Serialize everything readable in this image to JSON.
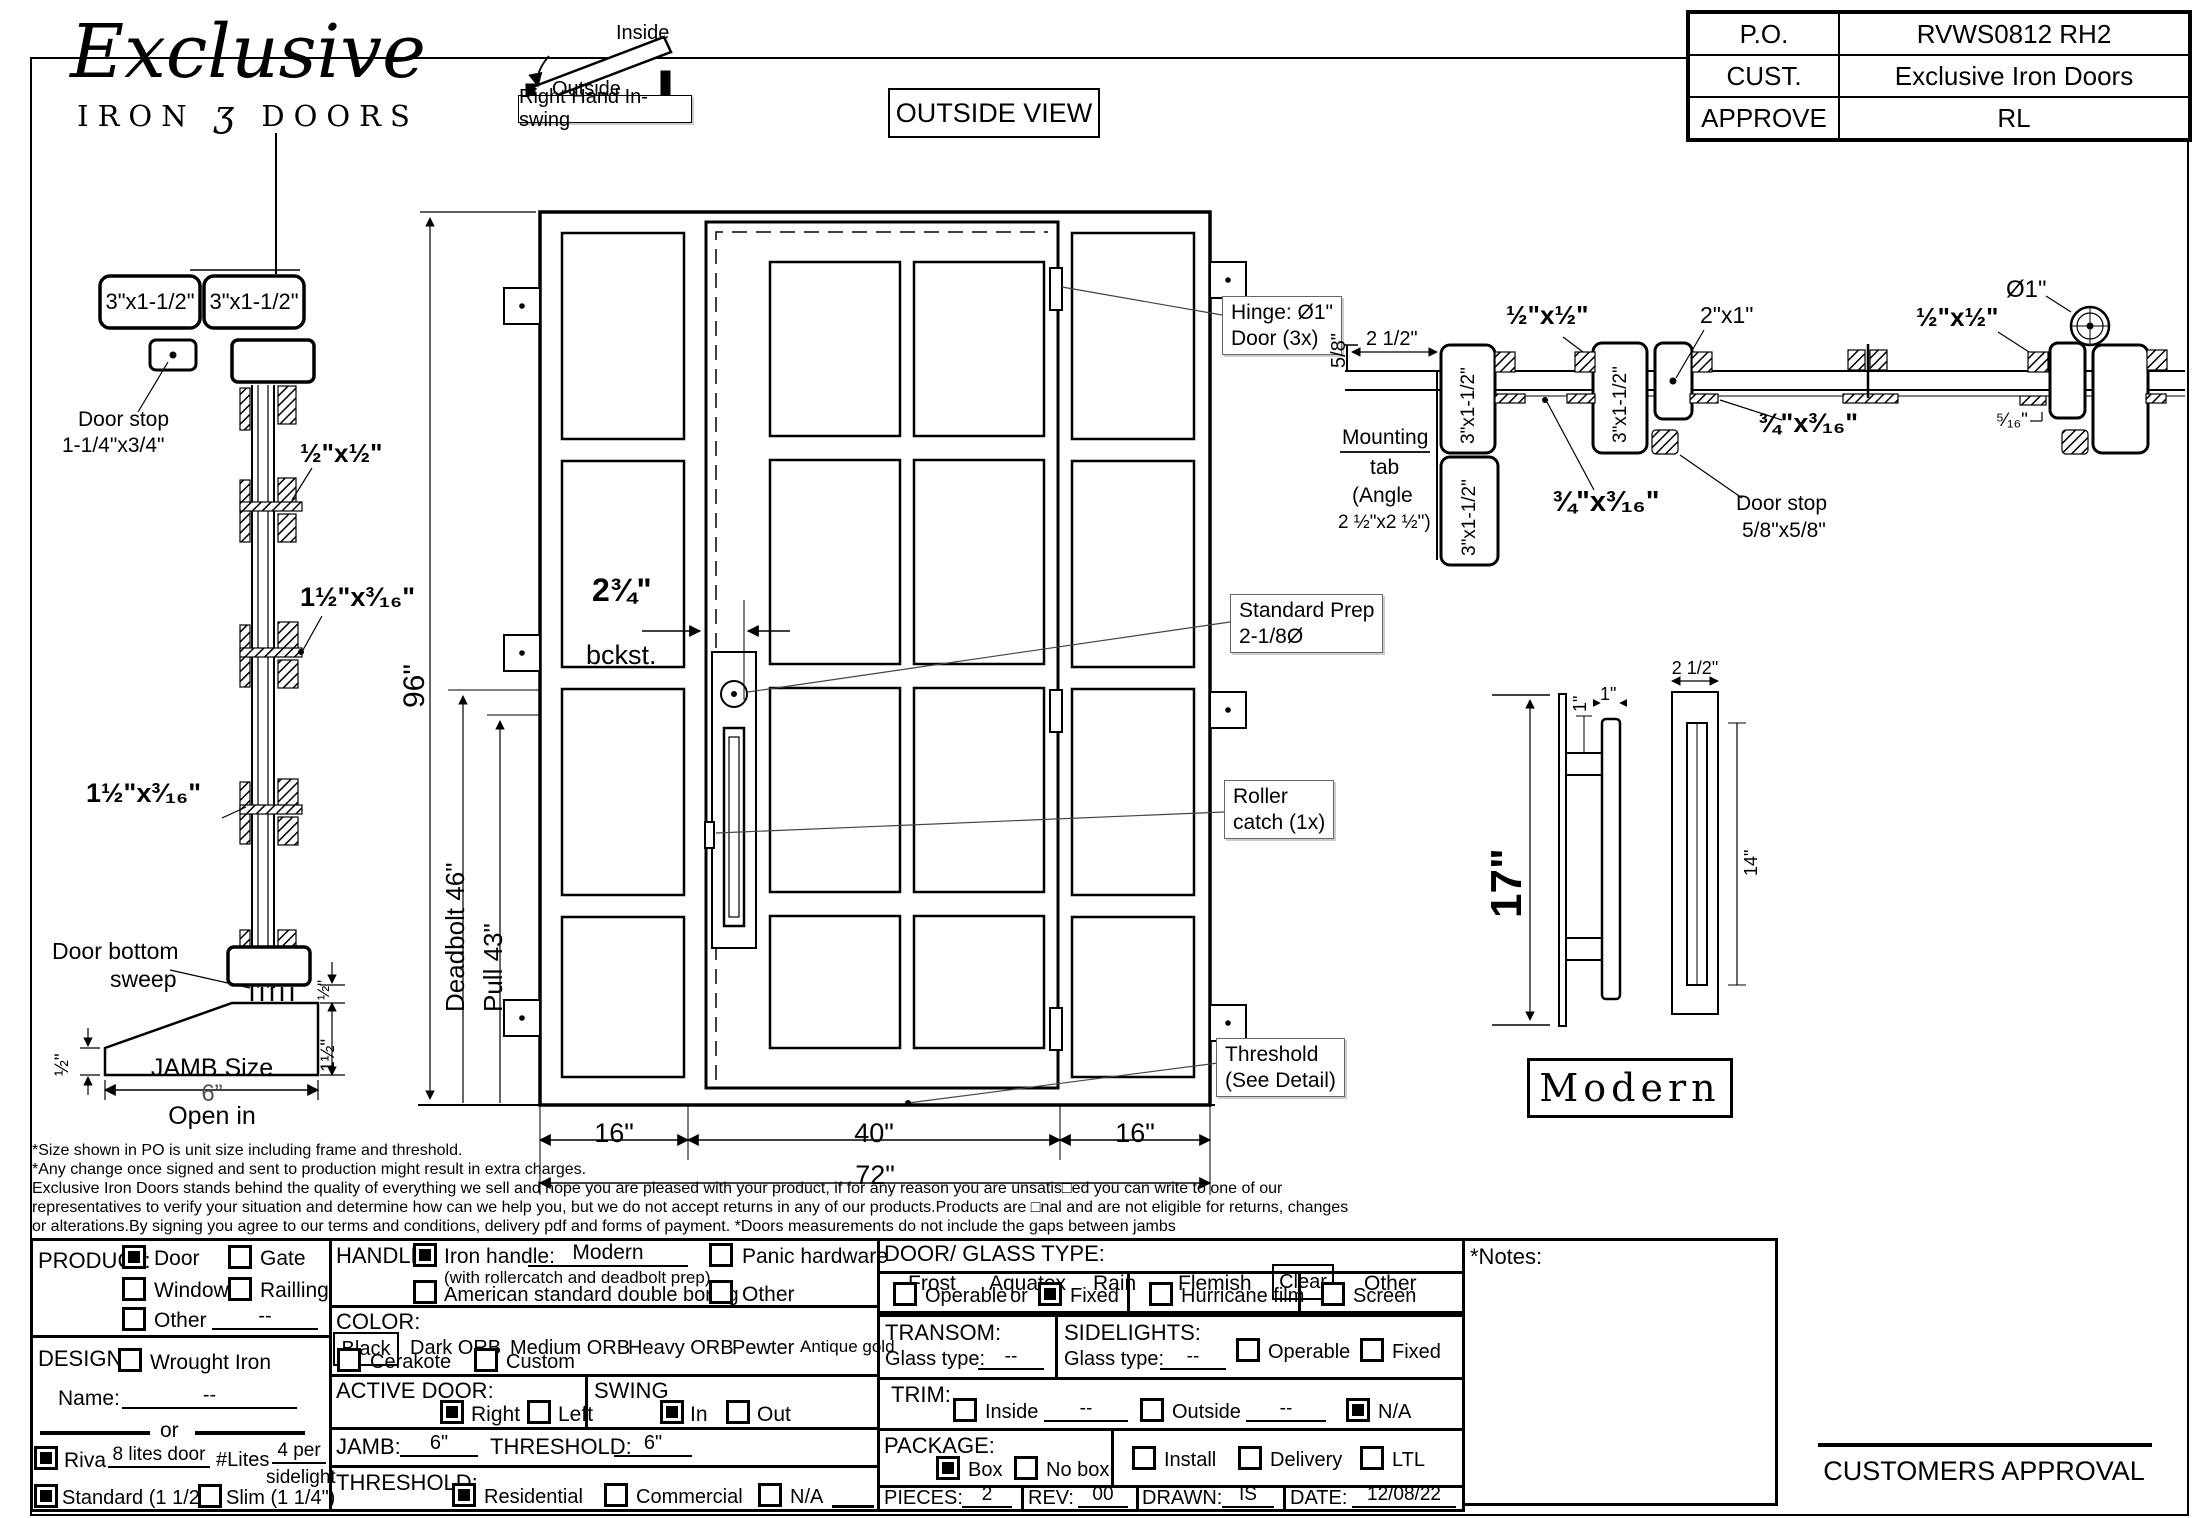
{
  "header": {
    "logo": {
      "name": "Exclusive",
      "sub_left": "IRON",
      "sub_glyph": "ʒ",
      "sub_right": "DOORS"
    },
    "swing": {
      "inside": "Inside",
      "outside": "Outside",
      "label": "Right Hand In-swing"
    },
    "view_label": "OUTSIDE VIEW",
    "po_table": {
      "po_label": "P.O.",
      "po_value": "RVWS0812 RH2",
      "cust_label": "CUST.",
      "cust_value": "Exclusive Iron Doors",
      "approve_label": "APPROVE",
      "approve_value": "RL"
    }
  },
  "drawing": {
    "jamb": {
      "tube_left": "3\"x1-1/2\"",
      "tube_right": "3\"x1-1/2\"",
      "door_stop_1": "Door stop",
      "door_stop_2": "1-1/4\"x3/4\"",
      "clip_half": "½\"x½\"",
      "clip_a": "1½\"x³⁄₁₆\"",
      "clip_b": "1½\"x³⁄₁₆\"",
      "sweep_1": "Door bottom",
      "sweep_2": "sweep",
      "dim_half_left": "½\"",
      "dim_half_right": "½\"",
      "dim_1half": "1½\"",
      "jamb_size": "JAMB Size",
      "jamb_val": "6”",
      "open_in": "Open in"
    },
    "elevation": {
      "height": "96\"",
      "deadbolt": "Deadbolt 46\"",
      "pull": "Pull 43\"",
      "backset_1": "2¾\"",
      "backset_2": "bckst.",
      "w_left": "16\"",
      "w_mid": "40\"",
      "w_right": "16\"",
      "w_total": "72\"",
      "hinge_1": "Hinge: Ø1\"",
      "hinge_2": "Door (3x)",
      "prep_1": "Standard Prep",
      "prep_2": "2-1/8Ø",
      "roller_1": "Roller",
      "roller_2": "catch (1x)",
      "thresh_1": "Threshold",
      "thresh_2": "(See Detail)"
    },
    "section": {
      "d58": "5/8\"",
      "d212": "2 1/2\"",
      "tube1": "3\"x1-1/2\"",
      "tube2": "3\"x1-1/2\"",
      "tube3": "3\"x1-1/2\"",
      "s12": "½\"x½\"",
      "s21": "2\"x1\"",
      "s34a": "¾\"x³⁄₁₆\"",
      "s34b": "¾\"x³⁄₁₆\"",
      "mount_1": "Mounting",
      "mount_2": "tab",
      "mount_3": "(Angle",
      "mount_4": "2 ½\"x2 ½\")",
      "stop_1": "Door stop",
      "stop_2": "5/8\"x5/8\"",
      "dia": "Ø1\"",
      "s12b": "½\"x½\"",
      "s516": "⁵⁄₁₆\""
    },
    "handle": {
      "h17": "17\"",
      "one_a": "1\"",
      "one_b": "1\"",
      "w212": "2 1/2\"",
      "h14": "14\"",
      "style": "Modern"
    }
  },
  "disclaimer": {
    "lines": [
      "*Size shown in PO is unit size including frame and threshold.",
      "*Any change once signed and sent to production might result in extra charges.",
      "Exclusive Iron Doors stands behind the quality of everything we sell and hope you are pleased with your product, if for any reason you are unsatis□ed you can write to one of our",
      "representatives to verify your situation and determine how can we help you, but we do not accept returns in any of our products.Products are □nal and are not eligible for returns, changes",
      "or alterations.By signing you agree to our terms and conditions, delivery pdf and forms of payment. *Doors measurements do not include the gaps between jambs"
    ]
  },
  "form": {
    "product": {
      "label": "PRODUCT:",
      "door": "Door",
      "gate": "Gate",
      "window": "Window",
      "railing": "Railling",
      "other": "Other",
      "other_value": "--"
    },
    "design": {
      "label": "DESIGN:",
      "wrought": "Wrought Iron",
      "name_label": "Name:",
      "name_value": "--",
      "or": "or",
      "riva": "Riva",
      "riva_value": "8 lites door",
      "lites_label": "#Lites",
      "lites_value": "4 per",
      "lites_value2": "sidelight",
      "standard": "Standard (1 1/2\")",
      "slim": "Slim (1 1/4\")"
    },
    "handle": {
      "label": "HANDLE:",
      "iron": "Iron handle:",
      "iron_value": "Modern",
      "iron_sub": "(with rollercatch and deadbolt prep)",
      "american": "American standard double boring",
      "panic": "Panic hardware",
      "other": "Other"
    },
    "color": {
      "label": "COLOR:",
      "selected": "Black",
      "opt1": "Dark ORB",
      "opt2": "Medium ORB",
      "opt3": "Heavy ORB",
      "opt4": "Pewter",
      "opt5": "Antique gold",
      "cerakote": "Cerakote",
      "custom": "Custom"
    },
    "active_door": {
      "label": "ACTIVE DOOR:",
      "right": "Right",
      "left": "Left"
    },
    "swing": {
      "label": "SWING",
      "in": "In",
      "out": "Out"
    },
    "jamb_row": {
      "label": "JAMB:",
      "value": "6\"",
      "t_label": "THRESHOLD:",
      "t_value": "6\""
    },
    "threshold": {
      "label": "THRESHOLD:",
      "residential": "Residential",
      "commercial": "Commercial",
      "na": "N/A"
    },
    "glass": {
      "label": "DOOR/ GLASS TYPE:",
      "frost": "Frost",
      "aquatex": "Aquatex",
      "rain": "Rain",
      "flemish": "Flemish",
      "clear": "Clear",
      "other": "Other",
      "operable": "Operable",
      "or": "or",
      "fixed": "Fixed",
      "hurricane": "Hurricane film",
      "screen": "Screen"
    },
    "transom": {
      "label": "TRANSOM:",
      "glass_type": "Glass type:",
      "value": "--"
    },
    "sidelights": {
      "label": "SIDELIGHTS:",
      "glass_type": "Glass type:",
      "value": "--",
      "operable": "Operable",
      "fixed": "Fixed"
    },
    "trim": {
      "label": "TRIM:",
      "inside": "Inside",
      "inside_value": "--",
      "outside": "Outside",
      "outside_value": "--",
      "na": "N/A"
    },
    "package": {
      "label": "PACKAGE:",
      "box": "Box",
      "nobox": "No box",
      "install": "Install",
      "delivery": "Delivery",
      "ltl": "LTL"
    },
    "meta": {
      "pieces_label": "PIECES:",
      "pieces": "2",
      "rev_label": "REV:",
      "rev": "00",
      "drawn_label": "DRAWN:",
      "drawn": "IS",
      "date_label": "DATE:",
      "date": "12/08/22"
    },
    "notes_label": "*Notes:",
    "approval": "CUSTOMERS APPROVAL"
  }
}
